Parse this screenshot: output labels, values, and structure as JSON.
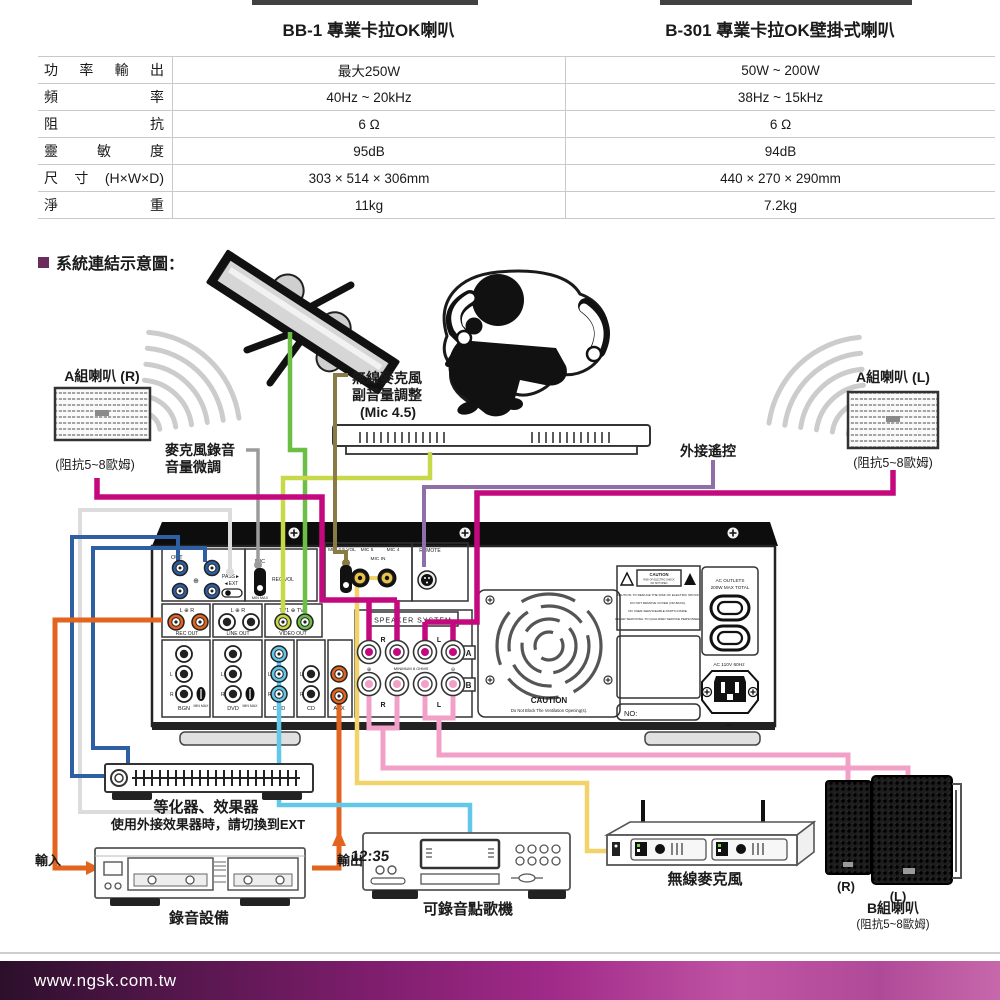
{
  "table": {
    "headers": [
      "BB-1 專業卡拉OK喇叭",
      "B-301 專業卡拉OK壁掛式喇叭"
    ],
    "rows": [
      {
        "label": "功率輸出",
        "bb1": "最大250W",
        "b301": "50W ~ 200W"
      },
      {
        "label": "頻率",
        "bb1": "40Hz ~ 20kHz",
        "b301": "38Hz ~ 15kHz"
      },
      {
        "label": "阻抗",
        "bb1": "6 Ω",
        "b301": "6 Ω"
      },
      {
        "label": "靈敏度",
        "bb1": "95dB",
        "b301": "94dB"
      },
      {
        "label": "尺寸(H×W×D)",
        "bb1": "303 × 514 × 306mm",
        "b301": "440 × 270 × 290mm"
      },
      {
        "label": "淨重",
        "bb1": "11kg",
        "b301": "7.2kg"
      }
    ]
  },
  "section_title": "系統連結示意圖：",
  "diagram": {
    "labels": {
      "speaker_a_r": "A組喇叭 (R)",
      "speaker_a_r_impedance": "(阻抗5~8歐姆)",
      "speaker_a_l": "A組喇叭 (L)",
      "speaker_a_l_impedance": "(阻抗5~8歐姆)",
      "mic_rec_line1": "麥克風錄音",
      "mic_rec_line2": "音量微調",
      "wireless_vol_line1": "無線麥克風",
      "wireless_vol_line2": "副音量調整",
      "wireless_vol_line3": "(Mic 4.5)",
      "remote": "外接遙控",
      "equalizer": "等化器、效果器",
      "equalizer_note": "使用外接效果器時，請切換到EXT",
      "recorder": "錄音設備",
      "input": "輸入",
      "output": "輸出",
      "karaoke": "可錄音點歌機",
      "karaoke_display": "12:35",
      "wireless_mic": "無線麥克風",
      "speaker_b": "B組喇叭",
      "speaker_b_impedance": "(阻抗5~8歐姆)",
      "speaker_b_r": "(R)",
      "speaker_b_l": "(L)"
    },
    "amp": {
      "out": "OUT",
      "pass": "PASS►",
      "ext": "◄EXT",
      "mic": "MIC",
      "rec_vol": "REC VOL",
      "min_max": "MIN MAX",
      "mic45": "MIC 4 5 VOL",
      "mic5": "MIC 5",
      "mic4": "MIC 4",
      "mic_in": "MIC IN",
      "remote": "REMOTE",
      "lr": "L ⊕ R",
      "tv": "TV1 ⊕ TV2",
      "rec_out": "REC OUT",
      "line_out": "LINE OUT",
      "video_out": "VIDEO OUT",
      "bgn": "BGN",
      "dvd": "DVD",
      "cmd": "CMD",
      "cd": "CD",
      "aux": "AUX",
      "speaker_system": "SPEAKER SYSTEM",
      "minimum": "MINIMUM 8 OHMS",
      "plus": "⊕",
      "minus": "⊖",
      "r": "R",
      "l": "L",
      "a": "A",
      "b": "B",
      "fan_caution": "CAUTION",
      "fan_caution_sub": "Do Not Block The Ventilation Opening(s).",
      "warn_caution": "CAUTION",
      "warn_risk": "RISK OF ELECTRIC SHOCK",
      "warn_open": "DO NOT OPEN",
      "warn_lines": [
        "CAUTION: TO REDUCE THE RISK OF ELECTRIC SHOCK",
        "DO NOT REMOVE COVER (OR BACK).",
        "NO USER-SERVICEABLE PARTS INSIDE.",
        "REFER SERVICING TO QUALIFIED SERVICE PERSONNEL."
      ],
      "ac_outlets": "AC OUTLETS",
      "ac_outlets_sub": "200W MAX TOTAL",
      "ac_power": "AC 110V 60Hz",
      "no_label": "NO:",
      "tilde": "~"
    }
  },
  "footer": {
    "url": "www.ngsk.com.tw"
  },
  "colors": {
    "title_square": "#6B2D5E",
    "footer_left": "#2c0f2b",
    "footer_mid": "#a02a88",
    "footer_right": "#c768ab",
    "wire_blue": "#2E5FA3",
    "wire_light_gray": "#DCDCDC",
    "wire_gray": "#9B9B9B",
    "wire_orange": "#E2641E",
    "wire_green": "#6CBF45",
    "wire_yellow_green": "#C8D84B",
    "wire_olive": "#8A7A46",
    "wire_yellow": "#F2D369",
    "wire_purple": "#8E6FA8",
    "wire_magenta": "#C4087E",
    "wire_pink": "#F2A0C8",
    "wire_cyan": "#62C8EA"
  }
}
